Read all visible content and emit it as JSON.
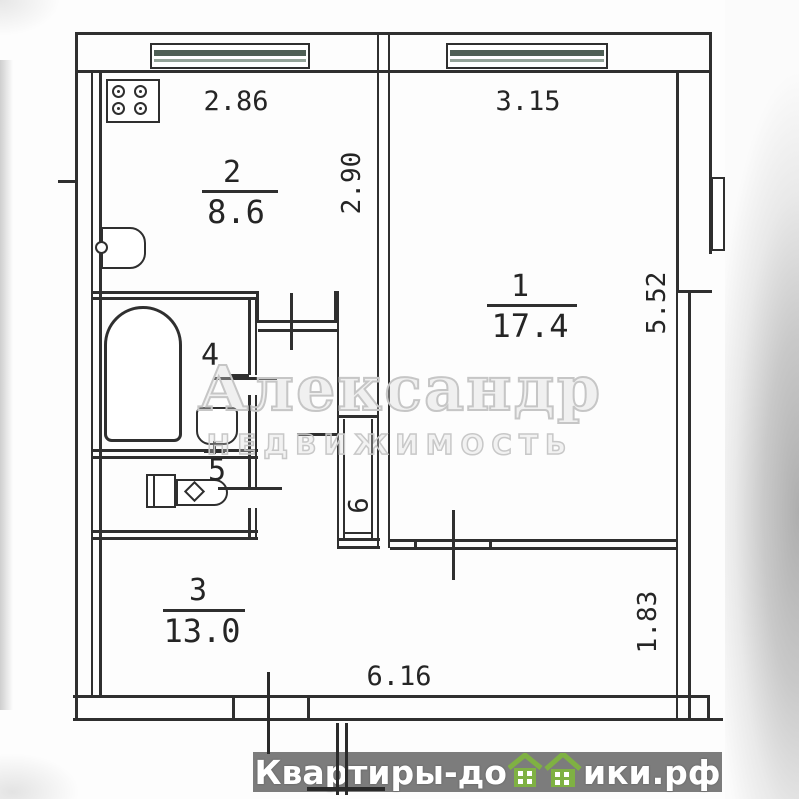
{
  "plan": {
    "room1": {
      "number": "1",
      "area": "17.4"
    },
    "room2": {
      "number": "2",
      "area": "8.6"
    },
    "room3": {
      "number": "3",
      "area": "13.0"
    },
    "room4": {
      "number": "4"
    },
    "room5": {
      "number": "5"
    },
    "room6": {
      "number": "6"
    },
    "dims": {
      "kitchen_width": "2.86",
      "room1_width": "3.15",
      "kitchen_depth": "2.90",
      "room1_depth": "5.52",
      "hall_depth": "1.83",
      "total_width": "6.16"
    }
  },
  "watermark": {
    "title": "Александр",
    "subtitle": "НЕДВИЖИМОСТЬ"
  },
  "footer": {
    "text_left": "Квартиры-до",
    "text_right": "ики.рф"
  },
  "colors": {
    "line": "#2f2f2f",
    "banner_bg": "#7c7c7c",
    "banner_text": "#ffffff",
    "house_green": "#7fb143",
    "watermark_gray": "#c6c6c6",
    "window_glass": "#4f5f55"
  }
}
